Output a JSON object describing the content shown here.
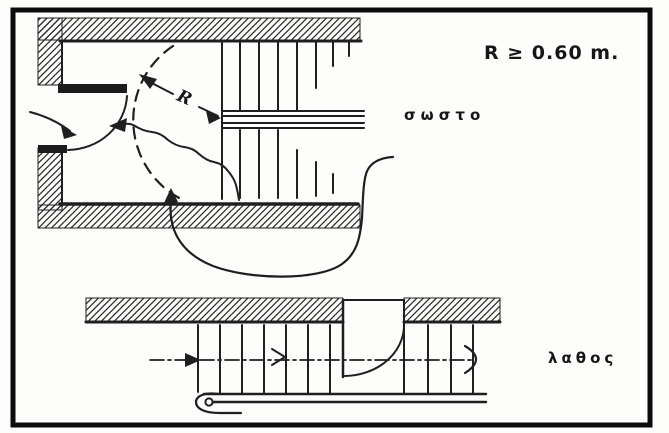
{
  "figure": {
    "annotation_radius": "R ≥ 0.60 m.",
    "radius_symbol": "R",
    "label_correct": "σωστο",
    "label_wrong": "λαθος"
  },
  "colors": {
    "ink": "#1f1f1f",
    "paper": "#fdfdfb",
    "frame": "#0c0c0c"
  }
}
